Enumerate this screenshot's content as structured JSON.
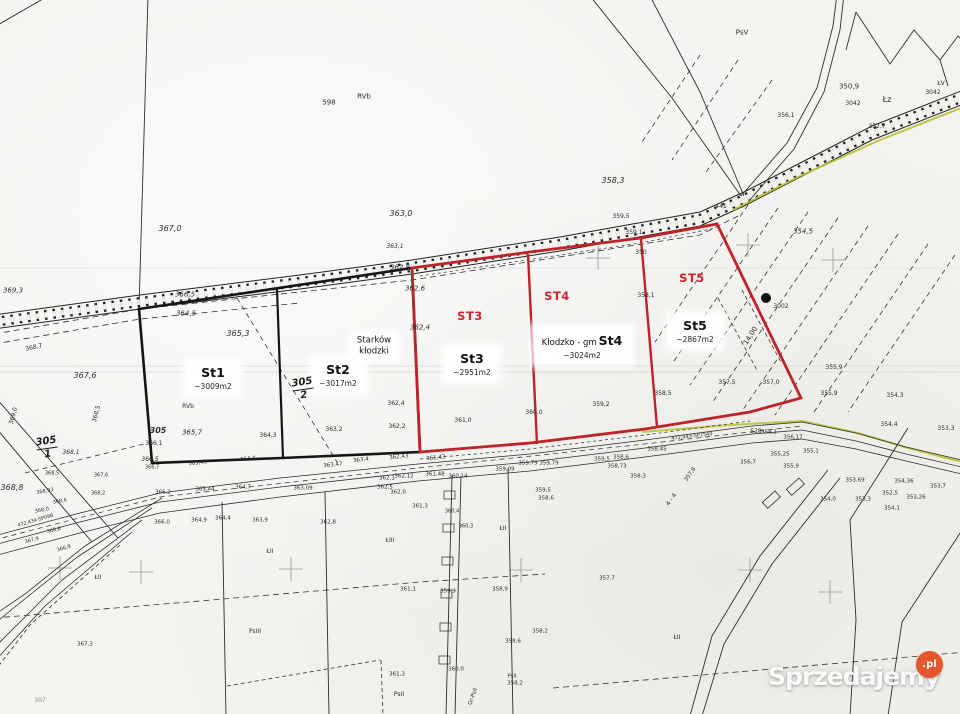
{
  "plots": {
    "st1": {
      "code": "St1",
      "area": "~3009m2"
    },
    "st2": {
      "code": "St2",
      "area": "~3017m2"
    },
    "st3": {
      "header": "ST3",
      "code": "St3",
      "area": "~2951m2"
    },
    "st4": {
      "header": "ST4",
      "code": "St4",
      "area": "~3024m2"
    },
    "st5": {
      "header": "ST5",
      "code": "St5",
      "area": "~2867m2"
    }
  },
  "place_labels": {
    "village_line1": "Starków",
    "village_line2": "kłodzki",
    "commune": "Kłodzko - gm"
  },
  "fractions": [
    {
      "num": "305",
      "den": "2"
    },
    {
      "num": "305",
      "den": "1"
    }
  ],
  "watermark": {
    "brand": "Sprzedajemy",
    "tld": ".pl"
  },
  "colors": {
    "plot_red": "#bf2228",
    "plot_red_text": "#cf2430",
    "line_black": "#2b2b2b",
    "vegetation_green": "#b3c433",
    "watermark_orange": "#e2572b"
  },
  "map_labels": [
    {
      "t": "367,0",
      "x": 170,
      "y": 229,
      "i": 1,
      "s": 8
    },
    {
      "t": "363,0",
      "x": 401,
      "y": 214,
      "i": 1,
      "s": 8
    },
    {
      "t": "358,3",
      "x": 613,
      "y": 181,
      "i": 1,
      "s": 8
    },
    {
      "t": "354,5",
      "x": 803,
      "y": 232,
      "i": 1,
      "s": 7
    },
    {
      "t": "PsV",
      "x": 742,
      "y": 33,
      "s": 7,
      "name": "land-class-label"
    },
    {
      "t": "350,9",
      "x": 849,
      "y": 87,
      "s": 7
    },
    {
      "t": "3042",
      "x": 853,
      "y": 104,
      "s": 6,
      "name": "parcel-number"
    },
    {
      "t": "Łz",
      "x": 887,
      "y": 100,
      "s": 8,
      "name": "land-class-label"
    },
    {
      "t": "ŁV",
      "x": 941,
      "y": 84,
      "s": 6,
      "name": "land-class-label"
    },
    {
      "t": "3042",
      "x": 933,
      "y": 93,
      "s": 6,
      "name": "parcel-number"
    },
    {
      "t": "352,7",
      "x": 877,
      "y": 127,
      "s": 6
    },
    {
      "t": "356,1",
      "x": 786,
      "y": 116,
      "s": 6
    },
    {
      "t": "441",
      "x": 721,
      "y": 207,
      "s": 6,
      "name": "parcel-number"
    },
    {
      "t": "359,5",
      "x": 621,
      "y": 217,
      "s": 6
    },
    {
      "t": "359,1",
      "x": 634,
      "y": 233,
      "s": 6
    },
    {
      "t": "350",
      "x": 641,
      "y": 253,
      "s": 6,
      "name": "parcel-number"
    },
    {
      "t": "598",
      "x": 329,
      "y": 103,
      "s": 7,
      "name": "parcel-number"
    },
    {
      "t": "RVb",
      "x": 364,
      "y": 97,
      "s": 7,
      "name": "land-class-label"
    },
    {
      "t": "3002",
      "x": 781,
      "y": 307,
      "s": 6,
      "name": "parcel-number"
    },
    {
      "t": "14,00",
      "x": 751,
      "y": 336,
      "s": 7,
      "r": -58
    },
    {
      "t": "369,3",
      "x": 13,
      "y": 291,
      "i": 1,
      "s": 7
    },
    {
      "t": "368,7",
      "x": 34,
      "y": 348,
      "s": 6,
      "r": -12
    },
    {
      "t": "367,6",
      "x": 85,
      "y": 376,
      "i": 1,
      "s": 8
    },
    {
      "t": "369,0",
      "x": 14,
      "y": 416,
      "s": 6,
      "r": -75
    },
    {
      "t": "368,5",
      "x": 97,
      "y": 414,
      "s": 6,
      "r": -75
    },
    {
      "t": "368,8",
      "x": 12,
      "y": 488,
      "i": 1,
      "s": 8
    },
    {
      "t": "366,5",
      "x": 185,
      "y": 295,
      "i": 1,
      "s": 7
    },
    {
      "t": "364,5",
      "x": 186,
      "y": 314,
      "i": 1,
      "s": 7
    },
    {
      "t": "365,3",
      "x": 238,
      "y": 334,
      "i": 1,
      "s": 8
    },
    {
      "t": "365,7",
      "x": 192,
      "y": 433,
      "i": 1,
      "s": 7
    },
    {
      "t": "RVb",
      "x": 188,
      "y": 407,
      "s": 6,
      "name": "land-class-label"
    },
    {
      "t": "305",
      "x": 158,
      "y": 431,
      "i": 1,
      "b": 1,
      "s": 8,
      "name": "parcel-number"
    },
    {
      "t": "366,1",
      "x": 154,
      "y": 444,
      "s": 6
    },
    {
      "t": "366,5",
      "x": 150,
      "y": 460,
      "i": 1,
      "s": 6
    },
    {
      "t": "366,7",
      "x": 152,
      "y": 468,
      "s": 5
    },
    {
      "t": "364,3",
      "x": 268,
      "y": 436,
      "s": 6
    },
    {
      "t": "363,2",
      "x": 334,
      "y": 430,
      "s": 6
    },
    {
      "t": "362,4",
      "x": 396,
      "y": 404,
      "s": 6
    },
    {
      "t": "362,2",
      "x": 397,
      "y": 427,
      "s": 6
    },
    {
      "t": "362,8",
      "x": 400,
      "y": 268,
      "i": 1,
      "s": 7
    },
    {
      "t": "362,6",
      "x": 415,
      "y": 289,
      "i": 1,
      "s": 7
    },
    {
      "t": "362,4",
      "x": 420,
      "y": 328,
      "i": 1,
      "s": 7
    },
    {
      "t": "363,1",
      "x": 395,
      "y": 247,
      "i": 1,
      "s": 6
    },
    {
      "t": "361,0",
      "x": 463,
      "y": 421,
      "s": 6
    },
    {
      "t": "360,0",
      "x": 534,
      "y": 413,
      "s": 6
    },
    {
      "t": "359,2",
      "x": 601,
      "y": 405,
      "s": 6
    },
    {
      "t": "358,5",
      "x": 663,
      "y": 394,
      "s": 6
    },
    {
      "t": "358,1",
      "x": 646,
      "y": 296,
      "s": 6
    },
    {
      "t": "357,5",
      "x": 727,
      "y": 383,
      "s": 6
    },
    {
      "t": "357,0",
      "x": 771,
      "y": 383,
      "s": 6
    },
    {
      "t": "355,9",
      "x": 834,
      "y": 368,
      "s": 6
    },
    {
      "t": "355,9",
      "x": 829,
      "y": 394,
      "s": 6
    },
    {
      "t": "354,3",
      "x": 895,
      "y": 396,
      "s": 6
    },
    {
      "t": "354,4",
      "x": 889,
      "y": 425,
      "s": 6
    },
    {
      "t": "353,3",
      "x": 946,
      "y": 429,
      "s": 6
    },
    {
      "t": "365,43",
      "x": 198,
      "y": 464,
      "s": 5.5,
      "r": -6
    },
    {
      "t": "364,4",
      "x": 248,
      "y": 460,
      "s": 5.5,
      "r": -6
    },
    {
      "t": "363,47",
      "x": 333,
      "y": 466,
      "s": 5.5,
      "r": -6
    },
    {
      "t": "363,4",
      "x": 361,
      "y": 461,
      "s": 5.5,
      "r": -6
    },
    {
      "t": "362,43",
      "x": 399,
      "y": 458,
      "s": 5.5,
      "r": -6
    },
    {
      "t": "361,43",
      "x": 436,
      "y": 459,
      "s": 5.5,
      "r": -6
    },
    {
      "t": "366,2",
      "x": 163,
      "y": 493,
      "s": 5.5
    },
    {
      "t": "365,44",
      "x": 205,
      "y": 490,
      "s": 5.5
    },
    {
      "t": "364,7",
      "x": 243,
      "y": 488,
      "s": 5.5
    },
    {
      "t": "363,09",
      "x": 303,
      "y": 489,
      "s": 5.5
    },
    {
      "t": "362,1",
      "x": 387,
      "y": 479,
      "s": 5.5
    },
    {
      "t": "362,12",
      "x": 404,
      "y": 477,
      "s": 5.5
    },
    {
      "t": "361,48",
      "x": 435,
      "y": 475,
      "s": 5.5
    },
    {
      "t": "362,5",
      "x": 385,
      "y": 488,
      "s": 5.5
    },
    {
      "t": "362,0",
      "x": 398,
      "y": 493,
      "s": 5.5
    },
    {
      "t": "360,14",
      "x": 458,
      "y": 477,
      "s": 5.5
    },
    {
      "t": "359,79",
      "x": 528,
      "y": 464,
      "s": 5.5
    },
    {
      "t": "359,79",
      "x": 549,
      "y": 464,
      "s": 5.5
    },
    {
      "t": "359,09",
      "x": 505,
      "y": 470,
      "s": 5.5
    },
    {
      "t": "359,5",
      "x": 602,
      "y": 460,
      "s": 5.5
    },
    {
      "t": "358,6",
      "x": 621,
      "y": 458,
      "s": 5.5
    },
    {
      "t": "358,45",
      "x": 657,
      "y": 450,
      "s": 5.5
    },
    {
      "t": "358,73",
      "x": 617,
      "y": 467,
      "s": 5.5
    },
    {
      "t": "359,5",
      "x": 543,
      "y": 491,
      "s": 5.5
    },
    {
      "t": "358,6",
      "x": 546,
      "y": 499,
      "s": 5.5
    },
    {
      "t": "358,3",
      "x": 638,
      "y": 477,
      "s": 5.5
    },
    {
      "t": "472,443-SP1540",
      "x": 692,
      "y": 437,
      "s": 5,
      "r": -7,
      "name": "benchmark-label"
    },
    {
      "t": "528",
      "x": 756,
      "y": 432,
      "s": 6,
      "name": "parcel-number"
    },
    {
      "t": "358,1",
      "x": 769,
      "y": 433,
      "s": 5.5
    },
    {
      "t": "356,17",
      "x": 793,
      "y": 438,
      "s": 5.5
    },
    {
      "t": "356,7",
      "x": 748,
      "y": 463,
      "s": 5.5
    },
    {
      "t": "355,9",
      "x": 791,
      "y": 467,
      "s": 5.5
    },
    {
      "t": "355,25",
      "x": 780,
      "y": 455,
      "s": 5.5
    },
    {
      "t": "355,1",
      "x": 811,
      "y": 452,
      "s": 5.5
    },
    {
      "t": "353,69",
      "x": 855,
      "y": 481,
      "s": 5.5
    },
    {
      "t": "354,36",
      "x": 904,
      "y": 482,
      "s": 5.5
    },
    {
      "t": "353,7",
      "x": 938,
      "y": 487,
      "s": 5.5
    },
    {
      "t": "353,26",
      "x": 916,
      "y": 498,
      "s": 5.5
    },
    {
      "t": "352,5",
      "x": 890,
      "y": 494,
      "s": 5.5
    },
    {
      "t": "354,0",
      "x": 828,
      "y": 500,
      "s": 5.5
    },
    {
      "t": "353,3",
      "x": 863,
      "y": 500,
      "s": 5.5
    },
    {
      "t": "354,1",
      "x": 892,
      "y": 509,
      "s": 5.5
    },
    {
      "t": "357,8",
      "x": 691,
      "y": 475,
      "s": 5.5,
      "r": -55
    },
    {
      "t": "4 - 4",
      "x": 672,
      "y": 500,
      "s": 6,
      "r": -55
    },
    {
      "t": "357,7",
      "x": 607,
      "y": 579,
      "s": 5.5
    },
    {
      "t": "366,0",
      "x": 162,
      "y": 523,
      "s": 5.5
    },
    {
      "t": "364,9",
      "x": 199,
      "y": 521,
      "s": 5.5
    },
    {
      "t": "364,4",
      "x": 223,
      "y": 519,
      "s": 5.5
    },
    {
      "t": "363,9",
      "x": 260,
      "y": 521,
      "s": 5.5
    },
    {
      "t": "362,8",
      "x": 328,
      "y": 523,
      "s": 5.5
    },
    {
      "t": "361,3",
      "x": 420,
      "y": 507,
      "s": 5.5
    },
    {
      "t": "360,4",
      "x": 452,
      "y": 512,
      "s": 5
    },
    {
      "t": "360,3",
      "x": 466,
      "y": 527,
      "s": 5
    },
    {
      "t": "ŁII",
      "x": 503,
      "y": 529,
      "s": 6,
      "name": "land-class-label"
    },
    {
      "t": "ŁII",
      "x": 270,
      "y": 552,
      "s": 6,
      "name": "land-class-label"
    },
    {
      "t": "ŁII",
      "x": 98,
      "y": 578,
      "s": 6,
      "name": "land-class-label"
    },
    {
      "t": "ŁII",
      "x": 677,
      "y": 638,
      "s": 6,
      "name": "land-class-label"
    },
    {
      "t": "ŁIII",
      "x": 390,
      "y": 541,
      "s": 6,
      "name": "land-class-label"
    },
    {
      "t": "PsIII",
      "x": 255,
      "y": 632,
      "s": 6,
      "name": "land-class-label"
    },
    {
      "t": "PsII",
      "x": 399,
      "y": 695,
      "s": 6,
      "name": "land-class-label"
    },
    {
      "t": "Gr-PsII",
      "x": 474,
      "y": 697,
      "s": 5.5,
      "r": -70,
      "name": "land-class-label"
    },
    {
      "t": "PsII",
      "x": 512,
      "y": 677,
      "s": 5.5,
      "name": "land-class-label"
    },
    {
      "t": "358,2",
      "x": 515,
      "y": 684,
      "s": 5.5
    },
    {
      "t": "358,2",
      "x": 540,
      "y": 632,
      "s": 5.5
    },
    {
      "t": "358,6",
      "x": 513,
      "y": 642,
      "s": 5.5
    },
    {
      "t": "360,0",
      "x": 456,
      "y": 670,
      "s": 5.5
    },
    {
      "t": "361,3",
      "x": 397,
      "y": 675,
      "s": 5.5
    },
    {
      "t": "359,9",
      "x": 448,
      "y": 592,
      "s": 5.5
    },
    {
      "t": "358,9",
      "x": 500,
      "y": 590,
      "s": 5.5
    },
    {
      "t": "361,1",
      "x": 408,
      "y": 590,
      "s": 5.5
    },
    {
      "t": "367,3",
      "x": 85,
      "y": 645,
      "s": 5.5
    },
    {
      "t": "307",
      "x": 40,
      "y": 701,
      "s": 6,
      "c": "gy",
      "name": "parcel-number"
    },
    {
      "t": "368,93",
      "x": 45,
      "y": 492,
      "s": 5,
      "r": -10
    },
    {
      "t": "368,6",
      "x": 60,
      "y": 502,
      "s": 5,
      "r": -10
    },
    {
      "t": "368,0",
      "x": 42,
      "y": 511,
      "s": 5,
      "r": -10
    },
    {
      "t": "472,434-SP09B",
      "x": 36,
      "y": 522,
      "s": 4.8,
      "r": -16,
      "name": "benchmark-label"
    },
    {
      "t": "368,8",
      "x": 54,
      "y": 531,
      "s": 5,
      "r": -12
    },
    {
      "t": "367,9",
      "x": 32,
      "y": 541,
      "s": 5,
      "r": -14
    },
    {
      "t": "366,9",
      "x": 64,
      "y": 549,
      "s": 5,
      "r": -16
    },
    {
      "t": "368,2",
      "x": 98,
      "y": 494,
      "s": 5
    },
    {
      "t": "367,6",
      "x": 101,
      "y": 476,
      "s": 5
    },
    {
      "t": "368,5",
      "x": 52,
      "y": 474,
      "s": 5
    },
    {
      "t": "368,1",
      "x": 71,
      "y": 453,
      "i": 1,
      "s": 6
    }
  ]
}
